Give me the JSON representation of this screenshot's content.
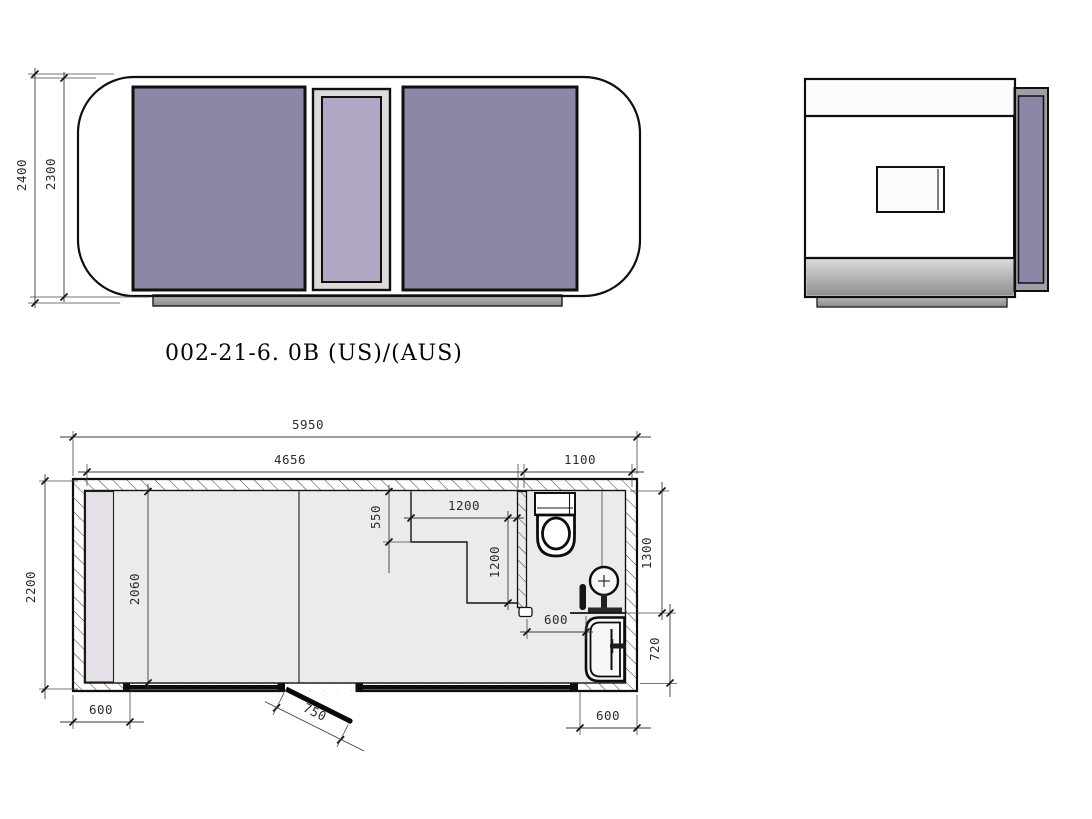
{
  "title": {
    "model_label": "002-21-6. 0B (US)/(AUS)"
  },
  "front_view": {
    "dims": {
      "overall_height": "2400",
      "body_height": "2300"
    }
  },
  "floor_plan": {
    "dims": {
      "overall_width": "5950",
      "main_width": "4656",
      "bath_width": "1100",
      "overall_depth": "2200",
      "interior_depth": "2060",
      "counter_offset": "550",
      "counter_width": "1200",
      "counter_depth": "1200",
      "bath_length": "1300",
      "shower_depth": "720",
      "bath_door_width": "600",
      "left_wall_segment": "600",
      "shower_width": "600",
      "door_leaf": "750"
    }
  },
  "colors": {
    "window_purple": "#8d86a6",
    "door_purple": "#b2a8c6",
    "panel_frame_gray": "#a29ea8",
    "body_fill": "#f4f3f5",
    "side_body_fill": "#f0eff1",
    "floor_fill": "#ebebec",
    "skid_gray": "#a8a8a8",
    "strip_lavender": "#e5e0e8",
    "fixture_fill": "#f7f7f9"
  }
}
